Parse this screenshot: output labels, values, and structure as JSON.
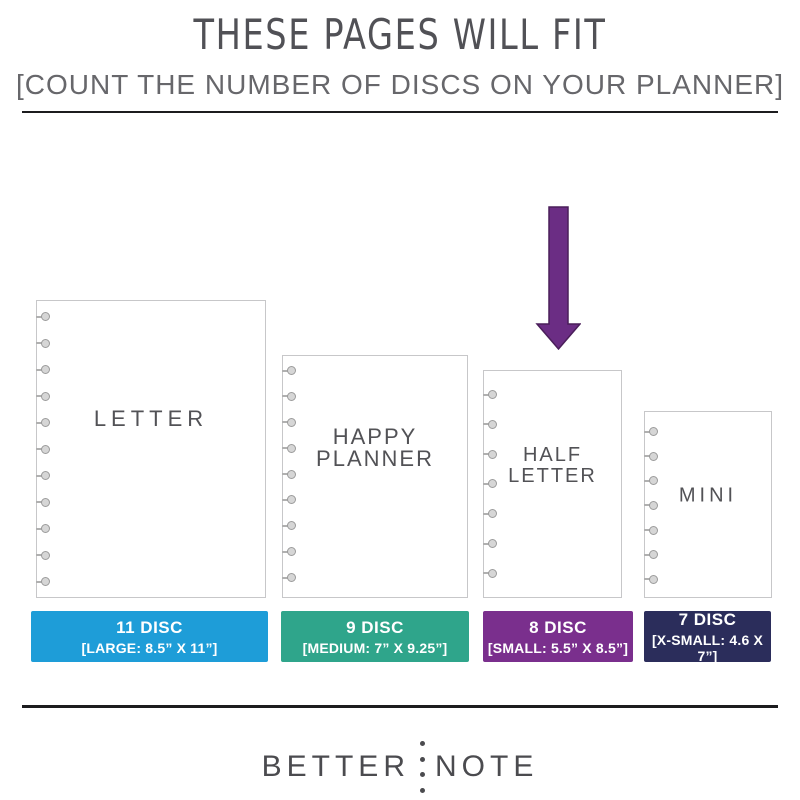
{
  "header": {
    "title": "THESE PAGES WILL FIT",
    "subtitle": "[COUNT THE NUMBER OF DISCS ON YOUR PLANNER]"
  },
  "arrow": {
    "icon": "down-arrow-icon",
    "color": "#6B2D84",
    "points_to": "HALF LETTER"
  },
  "pages": [
    {
      "id": "letter",
      "name": "LETTER",
      "name_lines": [
        "LETTER"
      ],
      "discs_shown": 11,
      "disc_label": "11 DISC",
      "size_label": "[LARGE: 8.5” X 11”]",
      "color": "#1E9DD8"
    },
    {
      "id": "happy-planner",
      "name": "HAPPY PLANNER",
      "name_lines": [
        "HAPPY",
        "PLANNER"
      ],
      "discs_shown": 9,
      "disc_label": "9 DISC",
      "size_label": "[MEDIUM: 7” X 9.25”]",
      "color": "#2FA58B"
    },
    {
      "id": "half-letter",
      "name": "HALF LETTER",
      "name_lines": [
        "HALF",
        "LETTER"
      ],
      "discs_shown": 7,
      "disc_label": "8 DISC",
      "size_label": "[SMALL: 5.5” X 8.5”]",
      "color": "#7A2F8D"
    },
    {
      "id": "mini",
      "name": "MINI",
      "name_lines": [
        "MINI"
      ],
      "discs_shown": 7,
      "disc_label": "7 DISC",
      "size_label": "[X-SMALL: 4.6 X 7”]",
      "color": "#2B2D5B"
    }
  ],
  "icons": {
    "disc": "disc-hole-icon",
    "colon": "logo-colon-icon"
  },
  "footer": {
    "logo_left": "BETTER",
    "logo_right": "NOTE",
    "colon_dots": 4
  }
}
